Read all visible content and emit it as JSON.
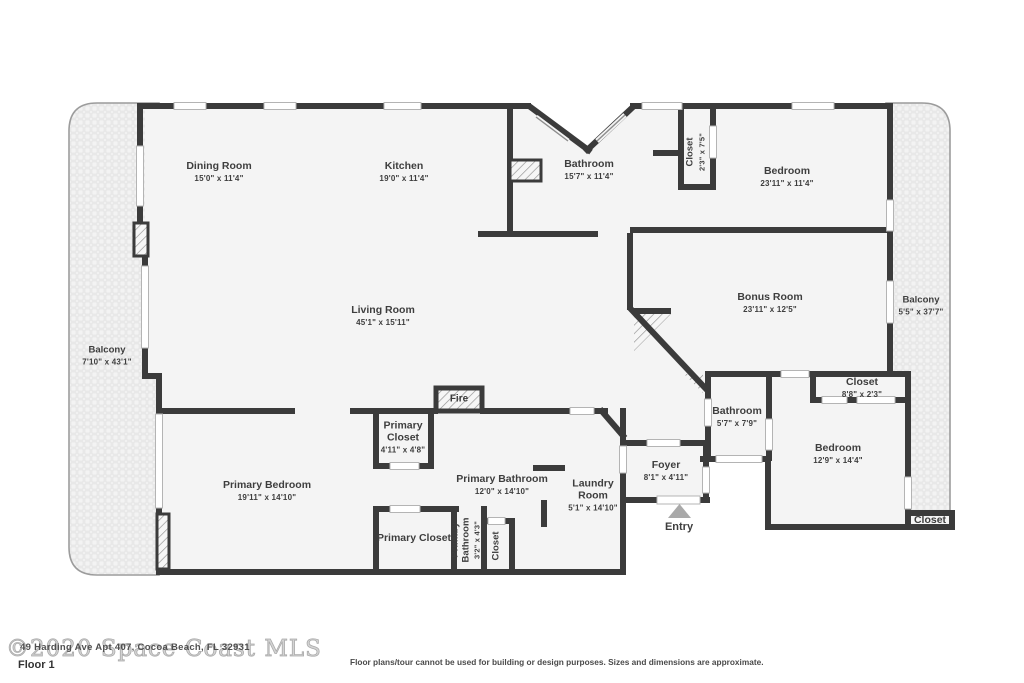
{
  "floor_label": "Floor 1",
  "watermark": "©2020 Space Coast MLS",
  "address_overlay": "49 Harding Ave Apt 407, Cocoa Beach, FL 32931",
  "disclaimer": "Floor plans/tour cannot be used for building or design purposes. Sizes and dimensions are approximate.",
  "entry": {
    "label": "Entry"
  },
  "fireplace": {
    "label": "Fire"
  },
  "colors": {
    "wall": "#3b3b3b",
    "floor": "#f4f4f4",
    "label_text": "#3e3e3e",
    "balcony_border": "#9c9c9c",
    "watermark_gray": "#ababab"
  },
  "rooms": [
    {
      "name": "Dining Room",
      "dims": "15'0\" x 11'4\""
    },
    {
      "name": "Kitchen",
      "dims": "19'0\" x 11'4\""
    },
    {
      "name": "Bathroom",
      "dims": "15'7\" x 11'4\""
    },
    {
      "name": "Closet",
      "dims": "2'3\" x 7'5\""
    },
    {
      "name": "Bedroom",
      "dims": "23'11\" x 11'4\""
    },
    {
      "name": "Living Room",
      "dims": "45'1\" x 15'11\""
    },
    {
      "name": "Bonus Room",
      "dims": "23'11\" x 12'5\""
    },
    {
      "name": "Balcony",
      "dims": "5'5\" x 37'7\""
    },
    {
      "name": "Balcony",
      "dims": "7'10\" x 43'1\""
    },
    {
      "name": "Closet",
      "dims": "8'8\" x 2'3\""
    },
    {
      "name": "Bathroom",
      "dims": "5'7\" x 7'9\""
    },
    {
      "name": "Bedroom",
      "dims": "12'9\" x 14'4\""
    },
    {
      "name": "Primary Closet",
      "dims": "4'11\" x 4'8\""
    },
    {
      "name": "Primary Bathroom",
      "dims": "12'0\" x 14'10\""
    },
    {
      "name": "Laundry Room",
      "dims": "5'1\" x 14'10\""
    },
    {
      "name": "Foyer",
      "dims": "8'1\" x 4'11\""
    },
    {
      "name": "Primary Bedroom",
      "dims": "19'11\" x 14'10\""
    },
    {
      "name": "Primary Closet",
      "dims": ""
    },
    {
      "name": "Primary Bathroom",
      "dims": "3'2\" x 4'3\""
    },
    {
      "name": "Closet",
      "dims": ""
    },
    {
      "name": "Closet",
      "dims": ""
    }
  ]
}
